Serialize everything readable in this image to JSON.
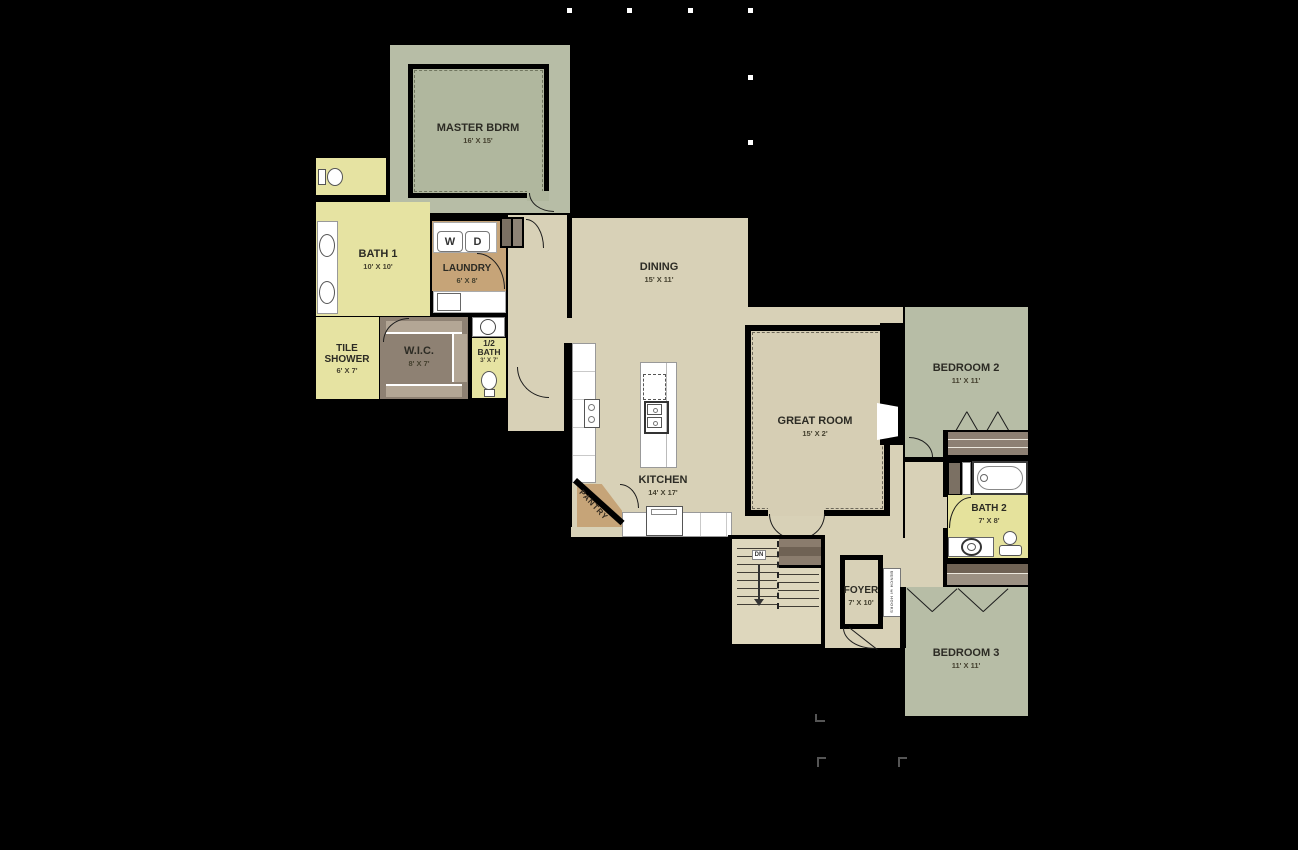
{
  "title": "First floor plan",
  "rooms": {
    "master": {
      "name": "MASTER BDRM",
      "dims": "16' X 15'"
    },
    "bath1": {
      "name": "BATH 1",
      "dims": "10' X 10'"
    },
    "laundry": {
      "name": "LAUNDRY",
      "dims": "6' X 8'"
    },
    "tile_shower": {
      "line1": "TILE",
      "line2": "SHOWER",
      "dims": "6' X 7'"
    },
    "wic": {
      "name": "W.I.C.",
      "dims": "8' X 7'"
    },
    "half_bath": {
      "line1": "1/2",
      "line2": "BATH",
      "dims": "3' X 7'"
    },
    "dining": {
      "name": "DINING",
      "dims": "15' X 11'"
    },
    "kitchen": {
      "name": "KITCHEN",
      "dims": "14' X 17'"
    },
    "pantry": {
      "name": "PANTRY"
    },
    "great_room": {
      "name": "GREAT ROOM",
      "dims": "15' X 2'"
    },
    "foyer": {
      "name": "FOYER",
      "dims": "7' X 10'"
    },
    "bedroom2": {
      "name": "BEDROOM 2",
      "dims": "11' X 11'"
    },
    "bath2": {
      "name": "BATH 2",
      "dims": "7' X 8'"
    },
    "bedroom3": {
      "name": "BEDROOM 3",
      "dims": "11' X 11'"
    }
  },
  "appliances": {
    "washer": "W",
    "dryer": "D"
  },
  "stairs": {
    "direction_label": "DN"
  },
  "foyer_bench": {
    "label": "BENCH w/ HOOKS"
  },
  "colors": {
    "wall": "#000000",
    "bedroom_green": "#b7bda6",
    "carpet_green": "#b0b79e",
    "floor_beige": "#d8d1b7",
    "great_carpet": "#d6ceb4",
    "bath_yellow": "#e6e3a2",
    "tan": "#c6a478",
    "taupe": "#8e8173",
    "closet_brown": "#8a7c6d",
    "closet_dark": "#6f6254",
    "closet_gray": "#9c9183"
  }
}
